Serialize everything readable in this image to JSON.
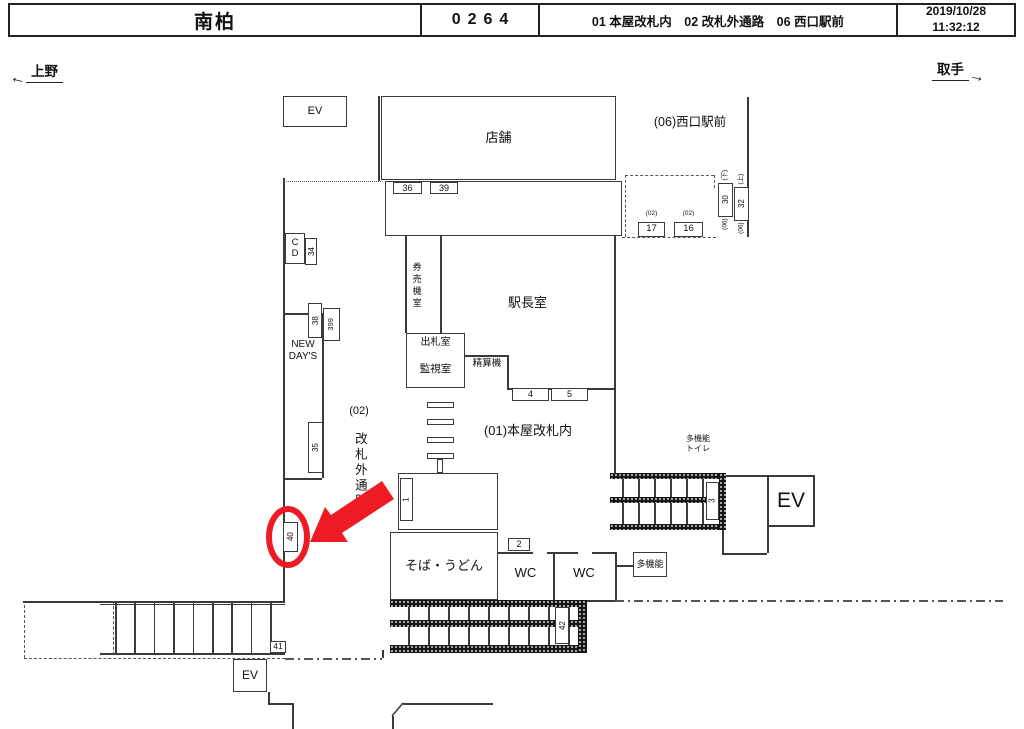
{
  "header": {
    "station_name": "南柏",
    "station_code": "0264",
    "locations": "01 本屋改札内　02 改札外通路　06 西口駅前",
    "date": "2019/10/28",
    "time": "11:32:12"
  },
  "directions": {
    "left_label": "上野",
    "right_label": "取手"
  },
  "colors": {
    "highlight_red": "#ed1c24",
    "line": "#3a3a3a"
  },
  "plan": {
    "boxes": [
      {
        "name": "ev-upper-box",
        "label": "EV",
        "x": 283,
        "y": 96,
        "w": 64,
        "h": 31,
        "fs": 11
      },
      {
        "name": "store-box",
        "label": "店舗",
        "x": 381,
        "y": 96,
        "w": 235,
        "h": 84,
        "fs": 13
      },
      {
        "name": "stair-band-top-box",
        "label": "",
        "x": 385,
        "y": 181,
        "w": 237,
        "h": 55
      },
      {
        "name": "box-36",
        "label": "36",
        "x": 393,
        "y": 182,
        "w": 29,
        "h": 12,
        "fs": 9
      },
      {
        "name": "box-39",
        "label": "39",
        "x": 430,
        "y": 182,
        "w": 28,
        "h": 12,
        "fs": 9
      },
      {
        "name": "cd-box",
        "label": "C\nD",
        "x": 285,
        "y": 233,
        "w": 20,
        "h": 31,
        "fs": 9.5
      },
      {
        "name": "box-34",
        "label": "34",
        "x": 305,
        "y": 238,
        "w": 12,
        "h": 27,
        "fs": 8,
        "rot": 1
      },
      {
        "name": "box-38",
        "label": "38",
        "x": 308,
        "y": 303,
        "w": 14,
        "h": 35,
        "fs": 8,
        "rot": 1
      },
      {
        "name": "box-399",
        "label": "399",
        "x": 323,
        "y": 308,
        "w": 17,
        "h": 33,
        "fs": 7.5,
        "rot": 1
      },
      {
        "name": "box-35",
        "label": "35",
        "x": 308,
        "y": 422,
        "w": 15,
        "h": 51,
        "fs": 8,
        "rot": 1
      },
      {
        "name": "box-40",
        "label": "40",
        "x": 283,
        "y": 522,
        "w": 15,
        "h": 30,
        "fs": 8,
        "rot": 1
      },
      {
        "name": "box-17",
        "label": "17",
        "x": 638,
        "y": 222,
        "w": 27,
        "h": 15,
        "fs": 9.5,
        "sup": "(02)"
      },
      {
        "name": "box-16",
        "label": "16",
        "x": 674,
        "y": 222,
        "w": 29,
        "h": 15,
        "fs": 9.5,
        "sup": "(02)"
      },
      {
        "name": "box-30",
        "label": "30",
        "x": 718,
        "y": 183,
        "w": 15,
        "h": 34,
        "fs": 8,
        "rot": 1,
        "sup": "(下)",
        "sub": "(06)"
      },
      {
        "name": "box-32",
        "label": "32",
        "x": 734,
        "y": 187,
        "w": 15,
        "h": 34,
        "fs": 8,
        "rot": 1,
        "sup": "(上)",
        "sub": "(06)"
      },
      {
        "name": "ticket-office-box",
        "label": "",
        "x": 406,
        "y": 333,
        "w": 59,
        "h": 55
      },
      {
        "name": "box-4",
        "label": "4",
        "x": 512,
        "y": 388,
        "w": 37,
        "h": 13,
        "fs": 9
      },
      {
        "name": "box-5",
        "label": "5",
        "x": 551,
        "y": 388,
        "w": 37,
        "h": 13,
        "fs": 9
      },
      {
        "name": "gate-bar",
        "label": "",
        "x": 427,
        "y": 402,
        "w": 27,
        "h": 6
      },
      {
        "name": "gate-bar",
        "label": "",
        "x": 427,
        "y": 419,
        "w": 27,
        "h": 6
      },
      {
        "name": "gate-bar",
        "label": "",
        "x": 427,
        "y": 437,
        "w": 27,
        "h": 6
      },
      {
        "name": "gate-bar",
        "label": "",
        "x": 427,
        "y": 453,
        "w": 27,
        "h": 6
      },
      {
        "name": "gate-post",
        "label": "",
        "x": 437,
        "y": 459,
        "w": 6,
        "h": 14
      },
      {
        "name": "center-stair-box",
        "label": "",
        "x": 398,
        "y": 473,
        "w": 100,
        "h": 57
      },
      {
        "name": "box-1",
        "label": "1",
        "x": 400,
        "y": 478,
        "w": 13,
        "h": 43,
        "fs": 8,
        "rot": 1
      },
      {
        "name": "soba-udon-box",
        "label": "そば・うどん",
        "x": 390,
        "y": 532,
        "w": 108,
        "h": 68,
        "fs": 13
      },
      {
        "name": "box-2",
        "label": "2",
        "x": 508,
        "y": 538,
        "w": 22,
        "h": 13,
        "fs": 9
      },
      {
        "name": "box-3",
        "label": "3",
        "x": 706,
        "y": 482,
        "w": 13,
        "h": 38,
        "fs": 8,
        "rot": 1
      },
      {
        "name": "ev-right-box",
        "label": "EV",
        "x": 767,
        "y": 475,
        "w": 48,
        "h": 52,
        "fs": 21,
        "bw": 2
      },
      {
        "name": "multi-function-box",
        "label": "多機能",
        "x": 633,
        "y": 552,
        "w": 34,
        "h": 25,
        "fs": 9
      },
      {
        "name": "box-42",
        "label": "42",
        "x": 555,
        "y": 607,
        "w": 14,
        "h": 37,
        "fs": 8,
        "rot": 1
      },
      {
        "name": "box-41",
        "label": "41",
        "x": 270,
        "y": 641,
        "w": 16,
        "h": 12,
        "fs": 8.5
      },
      {
        "name": "ev-lower-box",
        "label": "EV",
        "x": 233,
        "y": 659,
        "w": 34,
        "h": 33,
        "fs": 12
      }
    ],
    "lines": [
      {
        "name": "concourse-left-wall",
        "x": 283,
        "y": 178,
        "h": 425
      },
      {
        "name": "dotted-wall",
        "x": 283,
        "y": 181,
        "w": 98,
        "s": "dotted"
      },
      {
        "name": "store-left-wall",
        "x": 378,
        "y": 96,
        "h": 85
      },
      {
        "name": "stair-band-inner",
        "x": 385,
        "y": 186,
        "w": 237
      },
      {
        "name": "stair-treads-top",
        "x": 460,
        "y": 187,
        "h": 48,
        "n": 6,
        "dx": 27
      },
      {
        "name": "concourse-right-wall",
        "x": 614,
        "y": 236,
        "h": 237
      },
      {
        "name": "outer-right-wall",
        "x": 747,
        "y": 97,
        "h": 140
      },
      {
        "name": "ticket-machine-room-wall",
        "x": 405,
        "y": 236,
        "h": 97
      },
      {
        "name": "ticket-machine-room-wall",
        "x": 440,
        "y": 236,
        "h": 97
      },
      {
        "name": "ticket-office-divider",
        "x": 406,
        "y": 355,
        "w": 59
      },
      {
        "name": "fare-adjust-wall",
        "x": 465,
        "y": 355,
        "w": 42
      },
      {
        "name": "fare-adjust-wall",
        "x": 507,
        "y": 355,
        "h": 33
      },
      {
        "name": "stationmaster-south-wall",
        "x": 507,
        "y": 388,
        "w": 107
      },
      {
        "name": "wc-top-wall",
        "x": 498,
        "y": 552,
        "w": 35
      },
      {
        "name": "wc-top-wall",
        "x": 547,
        "y": 552,
        "w": 31
      },
      {
        "name": "wc-top-wall",
        "x": 592,
        "y": 552,
        "w": 23
      },
      {
        "name": "wc-divider",
        "x": 553,
        "y": 552,
        "h": 48
      },
      {
        "name": "wc-right-wall",
        "x": 615,
        "y": 552,
        "h": 48
      },
      {
        "name": "wc-bottom-wall",
        "x": 587,
        "y": 600,
        "w": 28
      },
      {
        "name": "multi-function-link",
        "x": 615,
        "y": 565,
        "w": 18
      },
      {
        "name": "boundary-dashdot",
        "x": 615,
        "y": 600,
        "w": 388,
        "s": "dashdot"
      },
      {
        "name": "bl-stair-top",
        "x": 23,
        "y": 601,
        "w": 262
      },
      {
        "name": "bl-stair-inner",
        "x": 100,
        "y": 604,
        "w": 185,
        "t": 1
      },
      {
        "name": "bl-stair-bottom",
        "x": 100,
        "y": 653,
        "w": 185
      },
      {
        "name": "bl-stair-treads",
        "x": 115,
        "y": 601,
        "h": 52,
        "n": 9,
        "dx": 19.4
      },
      {
        "name": "bl-dashed-wall",
        "x": 24,
        "y": 605,
        "h": 53,
        "s": "dashed"
      },
      {
        "name": "bl-dashed-wall",
        "x": 24,
        "y": 658,
        "w": 261,
        "s": "dashed"
      },
      {
        "name": "bl-dashed-wall",
        "x": 113,
        "y": 601,
        "h": 54,
        "s": "dashed"
      },
      {
        "name": "boundary-dashdot",
        "x": 285,
        "y": 658,
        "w": 97,
        "s": "dashdot"
      },
      {
        "name": "step-line",
        "x": 382,
        "y": 650,
        "h": 8
      },
      {
        "name": "ev-lower-step",
        "x": 268,
        "y": 692,
        "h": 11
      },
      {
        "name": "ev-lower-step",
        "x": 268,
        "y": 703,
        "w": 24
      },
      {
        "name": "ev-lower-step",
        "x": 292,
        "y": 703,
        "h": 26
      },
      {
        "name": "platform-edge",
        "x": 392,
        "y": 716,
        "h": 13
      },
      {
        "name": "platform-edge",
        "x": 403,
        "y": 703,
        "w": 90
      },
      {
        "name": "west-dashed-area",
        "x": 625,
        "y": 175,
        "w": 89,
        "s": "dashed"
      },
      {
        "name": "west-dashed-area",
        "x": 625,
        "y": 175,
        "h": 62,
        "s": "dashed"
      },
      {
        "name": "west-dashed-area",
        "x": 714,
        "y": 175,
        "h": 13,
        "s": "dashed"
      },
      {
        "name": "west-dashed-area",
        "x": 622,
        "y": 237,
        "w": 94,
        "s": "dashed"
      },
      {
        "name": "center-stair-inner",
        "x": 398,
        "y": 478,
        "w": 100
      },
      {
        "name": "center-stair-inner",
        "x": 398,
        "y": 524,
        "w": 100
      },
      {
        "name": "center-stair-treads",
        "x": 413,
        "y": 479,
        "h": 45,
        "n": 7,
        "dx": 12.2
      },
      {
        "name": "escalator-treads",
        "x": 622,
        "y": 479,
        "h": 18,
        "n": 6,
        "dx": 16
      },
      {
        "name": "escalator-treads",
        "x": 622,
        "y": 503,
        "h": 21,
        "n": 6,
        "dx": 16
      },
      {
        "name": "ev-landing-wall",
        "x": 726,
        "y": 475,
        "w": 41
      },
      {
        "name": "ev-landing-wall",
        "x": 722,
        "y": 530,
        "h": 23
      },
      {
        "name": "ev-landing-wall",
        "x": 722,
        "y": 553,
        "w": 45
      },
      {
        "name": "ev-landing-wall",
        "x": 767,
        "y": 527,
        "h": 26
      },
      {
        "name": "bottom-stair-treads",
        "x": 408,
        "y": 607,
        "h": 13,
        "n": 9,
        "dx": 20
      },
      {
        "name": "bottom-stair-treads",
        "x": 408,
        "y": 627,
        "h": 18,
        "n": 9,
        "dx": 20
      }
    ],
    "hatches": [
      {
        "name": "escalator-hatch",
        "x": 610,
        "y": 473,
        "w": 116,
        "h": 6
      },
      {
        "name": "escalator-hatch",
        "x": 610,
        "y": 497,
        "w": 96,
        "h": 6
      },
      {
        "name": "escalator-hatch",
        "x": 610,
        "y": 524,
        "w": 116,
        "h": 6
      },
      {
        "name": "escalator-hatch",
        "x": 719,
        "y": 473,
        "w": 7,
        "h": 57
      },
      {
        "name": "bottom-stair-hatch",
        "x": 390,
        "y": 600,
        "w": 197,
        "h": 7
      },
      {
        "name": "bottom-stair-hatch",
        "x": 390,
        "y": 620,
        "w": 189,
        "h": 7
      },
      {
        "name": "bottom-stair-hatch",
        "x": 390,
        "y": 645,
        "w": 189,
        "h": 8
      },
      {
        "name": "bottom-stair-hatch",
        "x": 578,
        "y": 600,
        "w": 9,
        "h": 53
      }
    ],
    "labels": [
      {
        "name": "stationmaster-room-label",
        "text": "駅長室",
        "x": 470,
        "y": 295,
        "w": 115,
        "h": 16,
        "fs": 13
      },
      {
        "name": "ticket-machine-room-label",
        "text": "券売機室",
        "x": 408,
        "y": 247,
        "w": 16,
        "h": 78,
        "fs": 9,
        "vert": 1
      },
      {
        "name": "fare-adjust-label",
        "text": "精算機",
        "x": 467,
        "y": 357,
        "w": 40,
        "h": 13,
        "fs": 9.5
      },
      {
        "name": "ticket-window-label",
        "text": "出札室",
        "x": 406,
        "y": 336,
        "w": 59,
        "h": 14,
        "fs": 10
      },
      {
        "name": "monitor-room-label",
        "text": "監視室",
        "x": 406,
        "y": 362,
        "w": 59,
        "h": 15,
        "fs": 10.5
      },
      {
        "name": "inside-gate-area-label",
        "text": "(01)本屋改札内",
        "x": 468,
        "y": 423,
        "w": 120,
        "h": 16,
        "fs": 13
      },
      {
        "name": "west-exit-area-label",
        "text": "(06)西口駅前",
        "x": 640,
        "y": 115,
        "w": 100,
        "h": 16,
        "fs": 12.5
      },
      {
        "name": "outside-gate-area-prefix",
        "text": "(02)",
        "x": 342,
        "y": 405,
        "w": 34,
        "h": 14,
        "fs": 11
      },
      {
        "name": "outside-gate-area-label",
        "text": "改札外通路",
        "x": 350,
        "y": 421,
        "w": 18,
        "h": 100,
        "fs": 12.5,
        "vert": 1
      },
      {
        "name": "newdays-label",
        "text": "NEW\nDAY'S",
        "x": 280,
        "y": 337,
        "w": 46,
        "h": 28,
        "fs": 10
      },
      {
        "name": "multi-function-toilet-label",
        "text": "多機能\nトイレ",
        "x": 680,
        "y": 432,
        "w": 36,
        "h": 24,
        "fs": 8
      },
      {
        "name": "wc-left-label",
        "text": "WC",
        "x": 498,
        "y": 562,
        "w": 55,
        "h": 22,
        "fs": 13
      },
      {
        "name": "wc-right-label",
        "text": "WC",
        "x": 553,
        "y": 562,
        "w": 62,
        "h": 22,
        "fs": 13
      }
    ],
    "newdays_walls": [
      {
        "name": "newdays-wall",
        "x": 283,
        "y": 313,
        "w": 25
      },
      {
        "name": "newdays-wall",
        "x": 322,
        "y": 313,
        "h": 165
      },
      {
        "name": "newdays-wall",
        "x": 283,
        "y": 478,
        "w": 39
      }
    ],
    "highlight": {
      "ellipse": {
        "cx": 288,
        "cy": 537,
        "rx": 19,
        "ry": 28,
        "sw": 6
      },
      "arrow_points": "310,542 325,507 331,515 382,481 394,499 342,533 348,542"
    },
    "diag_line": {
      "x1": 392,
      "y1": 716,
      "x2": 403,
      "y2": 703
    }
  }
}
